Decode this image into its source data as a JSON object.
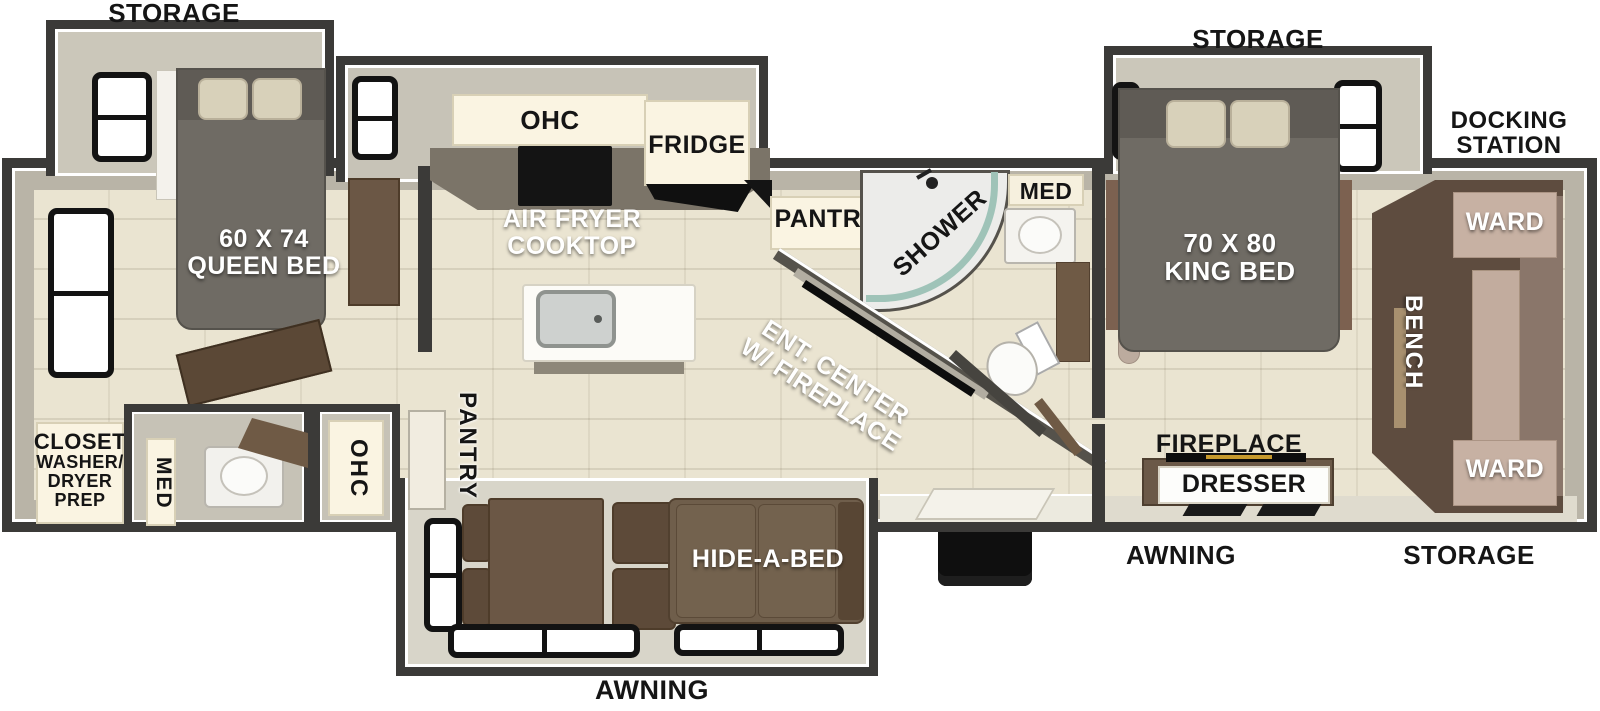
{
  "plan": {
    "exterior_labels": {
      "storage_front": "STORAGE",
      "storage_rear_top": "STORAGE",
      "docking_station": [
        "DOCKING",
        "STATION"
      ],
      "awning_main": "AWNING",
      "awning_rear": "AWNING",
      "storage_rear_bottom": "STORAGE"
    },
    "front_bedroom": {
      "bed": [
        "60 X 74",
        "QUEEN BED"
      ],
      "closet": [
        "CLOSET",
        "WASHER/",
        "DRYER",
        "PREP"
      ],
      "med": "MED",
      "ohc": "OHC"
    },
    "kitchen": {
      "ohc": "OHC",
      "fridge": "FRIDGE",
      "cooktop": [
        "AIR FRYER",
        "COOKTOP"
      ],
      "pantry": "PANTRY",
      "pantry_tall": "PANTRY"
    },
    "bathroom": {
      "shower": "SHOWER",
      "med": "MED"
    },
    "living_room": {
      "ent_center": [
        "ENT. CENTER",
        "W/ FIREPLACE"
      ],
      "hide_a_bed": "HIDE-A-BED"
    },
    "rear_bedroom": {
      "bed": [
        "70 X 80",
        "KING BED"
      ],
      "ward_top": "WARD",
      "bench": "BENCH",
      "ward_bottom": "WARD",
      "fireplace": "FIREPLACE",
      "dresser": "DRESSER"
    },
    "colors": {
      "wall": "#3b3a38",
      "wall_face": "#b9b4a7",
      "floor_tile": "#eae4d1",
      "slide_floor": "#d8d5c9",
      "furniture_brown": "#6b5745",
      "ward_tan": "#c7b1a3",
      "bed_gray": "#6f6b64",
      "cabinet_cream": "#faf4e2"
    }
  }
}
